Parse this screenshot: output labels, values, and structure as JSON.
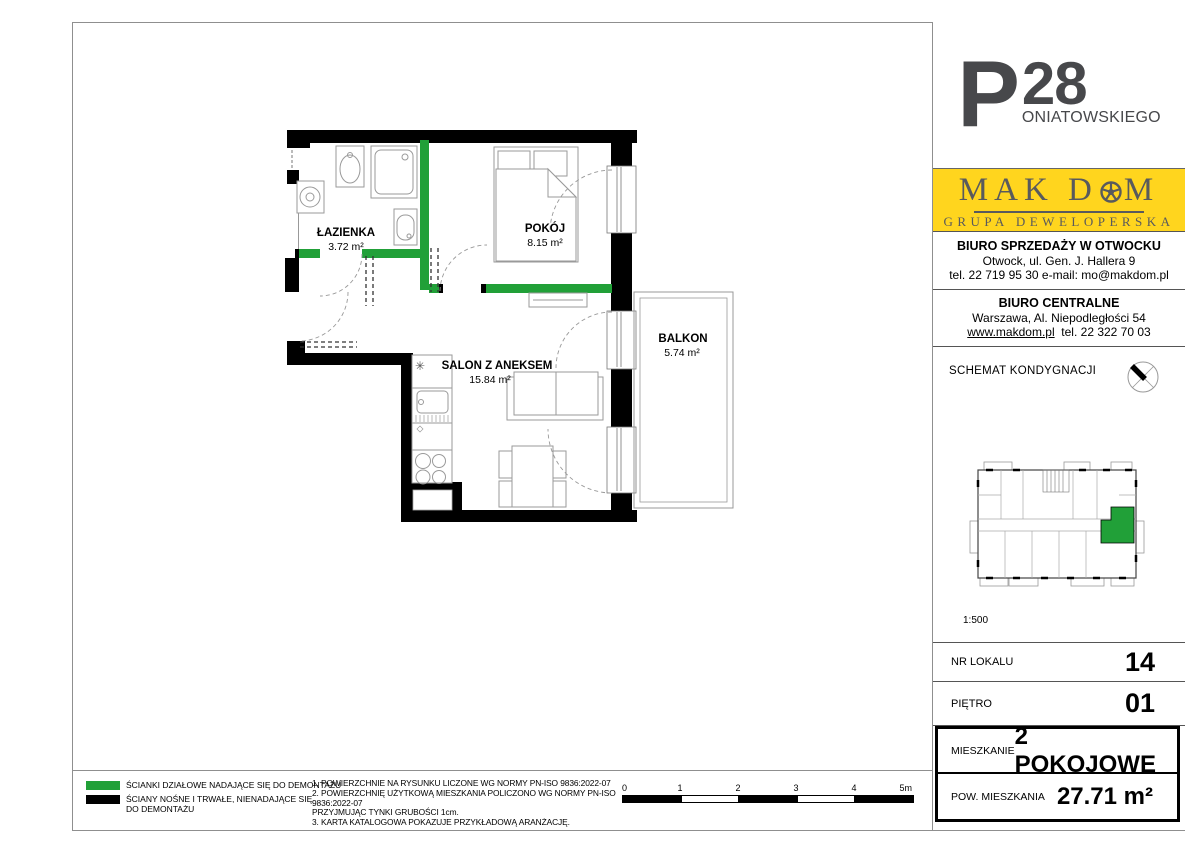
{
  "project": {
    "logo_initial": "P",
    "logo_number": "28",
    "logo_name_rest": "ONIATOWSKIEGO"
  },
  "developer": {
    "brand_part1": "MAK",
    "brand_part2": "D",
    "brand_part3": "M",
    "subtitle": "GRUPA DEWELOPERSKA"
  },
  "offices": {
    "sales": {
      "title": "BIURO SPRZEDAŻY W OTWOCKU",
      "line1": "Otwock, ul. Gen. J. Hallera 9",
      "line2": "tel. 22 719 95 30   e-mail: mo@makdom.pl"
    },
    "central": {
      "title": "BIURO CENTRALNE",
      "line1": "Warszawa, Al. Niepodległości 54",
      "website": "www.makdom.pl",
      "phone": "tel. 22 322 70 03"
    }
  },
  "schematic": {
    "title": "SCHEMAT KONDYGNACJI",
    "scale": "1:500"
  },
  "unit_info": {
    "rows": [
      {
        "label": "NR LOKALU",
        "value": "14"
      },
      {
        "label": "PIĘTRO",
        "value": "01"
      }
    ],
    "box": [
      {
        "label": "MIESZKANIE",
        "value": "2 POKOJOWE"
      },
      {
        "label": "POW. MIESZKANIA",
        "value": "27.71 m²"
      }
    ]
  },
  "plan": {
    "rooms": [
      {
        "name": "ŁAZIENKA",
        "area": "3.72 m²"
      },
      {
        "name": "POKÓJ",
        "area": "8.15 m²"
      },
      {
        "name": "SALON Z ANEKSEM",
        "area": "15.84 m²"
      },
      {
        "name": "BALKON",
        "area": "5.74 m²"
      }
    ],
    "kitchen_mark": "✳"
  },
  "legend": {
    "items": [
      {
        "color": "#21A038",
        "lines": [
          "ŚCIANKI DZIAŁOWE NADAJĄCE SIĘ DO DEMONTAŻU"
        ]
      },
      {
        "color": "#000000",
        "lines": [
          "ŚCIANY NOŚNE I TRWAŁE, NIENADAJĄCE SIĘ",
          "DO DEMONTAŻU"
        ]
      }
    ]
  },
  "notes": {
    "lines": [
      "1. POWIERZCHNIE NA RYSUNKU LICZONE WG NORMY PN-ISO 9836:2022-07",
      "2. POWIERZCHNIĘ UŻYTKOWĄ MIESZKANIA POLICZONO WG NORMY PN-ISO 9836:2022-07",
      "PRZYJMUJĄC TYNKI GRUBOŚCI 1cm.",
      "3. KARTA KATALOGOWA POKAZUJE PRZYKŁADOWĄ ARANŻACJĘ."
    ]
  },
  "scalebar": {
    "labels": [
      "0",
      "1",
      "2",
      "3",
      "4",
      "5m"
    ]
  },
  "colors": {
    "partition_wall": "#21A038",
    "load_bearing_wall": "#000000",
    "brand_yellow": "#FFD51E",
    "highlight_unit": "#21A038"
  }
}
